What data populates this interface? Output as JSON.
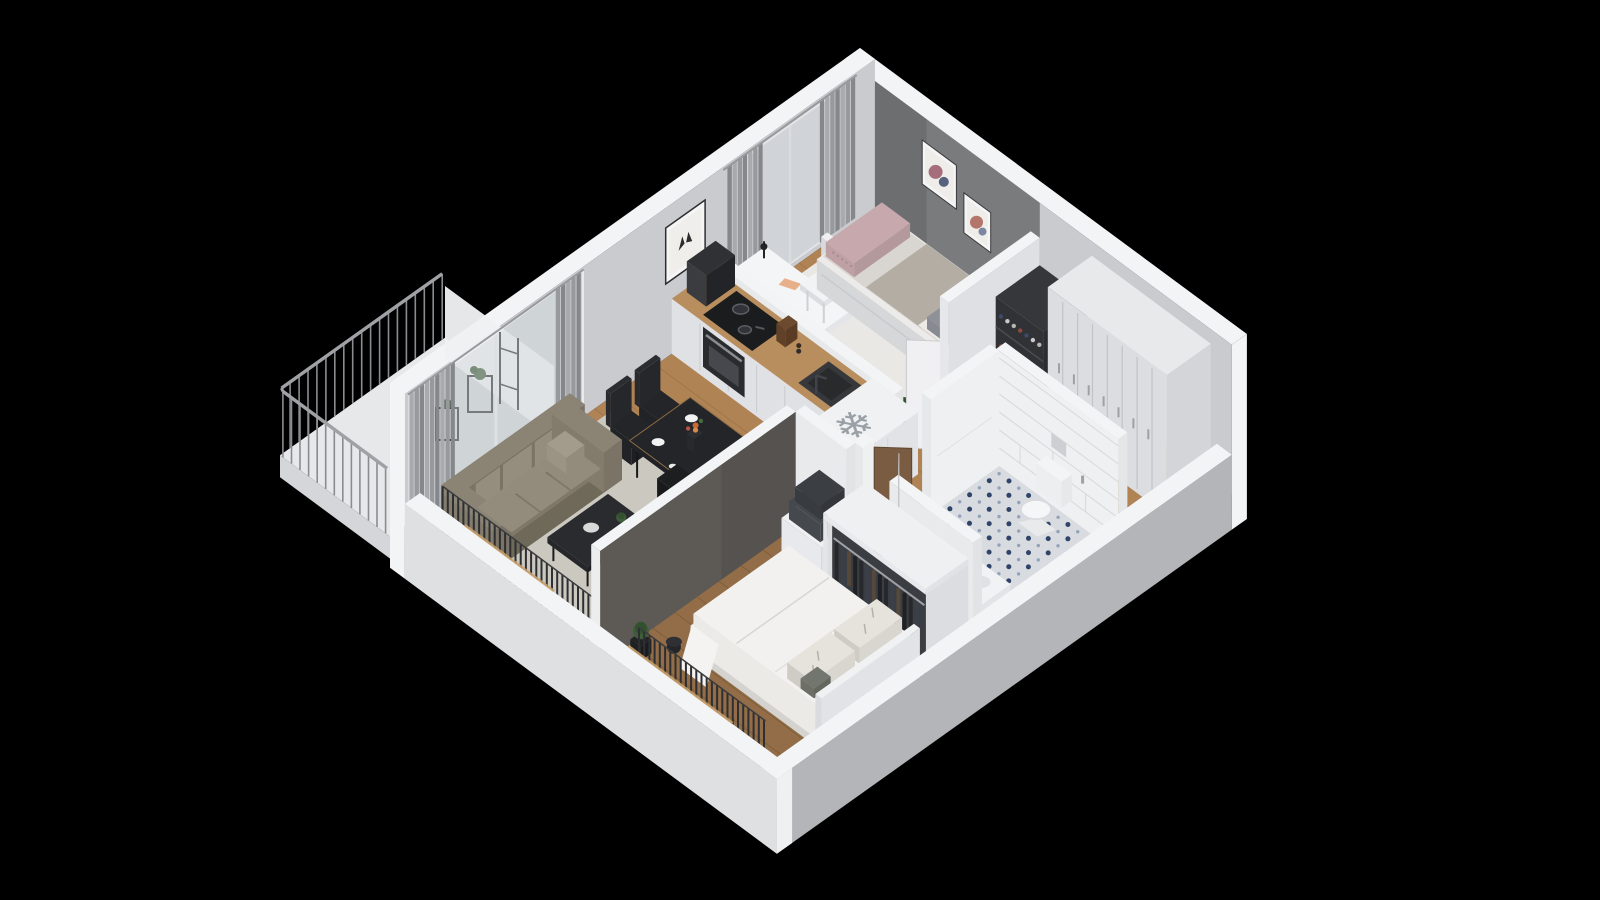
{
  "scene": {
    "description": "isometric-3d-apartment-floorplan-render",
    "background": "#000000",
    "rooms": [
      "living-room",
      "dining-area",
      "kitchen",
      "small-bedroom",
      "bedroom",
      "bathroom",
      "hallway-wardrobe",
      "balcony"
    ],
    "objects": [
      "balcony-railing",
      "balcony-planters",
      "sofa",
      "coffee-table",
      "floor-lamp",
      "living-rug",
      "dining-table",
      "dining-chairs",
      "kitchen-counter",
      "cooktop",
      "oven",
      "coffee-machine",
      "sink",
      "fridge-freezer-unit",
      "daybed",
      "desk",
      "desk-chair",
      "wall-art-frames",
      "butterfly-frame",
      "wardrobe",
      "shoe-rack",
      "toilet",
      "bathroom-vanity",
      "patterned-tile-floor",
      "double-bed",
      "open-closet",
      "storage-boxes",
      "radiators",
      "plants",
      "doors"
    ],
    "icons": {
      "freezer": {
        "name": "snowflake-icon",
        "glyph": "❄"
      }
    }
  },
  "palette": {
    "background": "#000000",
    "wallTop": "#f3f4f6",
    "wallOuterRight": "#b3b5b8",
    "wallOuterBottom": "#dfe0e2",
    "wallInner": "#c9cbce",
    "accentGray": "#797b7d",
    "partitionDark": "#5d5a56",
    "floorWood": "#b08355",
    "floorWoodDark": "#926d47",
    "plankLine": "#7d5833",
    "rugLiving": "#cbc8c0",
    "rugBedroom": "#e9e8e4",
    "bathTileFloor": "#d8dbdf",
    "bathPatternNavy": "#2f4468",
    "bathPatternBlue": "#93a2bb",
    "bathTileWall": "#eef0f1",
    "counterWood": "#b98e5e",
    "cabinetWhite": "#e0e1e4",
    "applianceDark": "#2a2b2e",
    "windowGlass": "#ccd1d5",
    "curtainDark": "#85878b",
    "curtainMid": "#97999d",
    "curtainLight": "#a8aaae",
    "sheer": "#d3d6d9",
    "sofaTaupe": "#847d6e",
    "blackFurniture": "#232528",
    "duvetWhite": "#f2f1ef",
    "bedFrame": "#e8e7e4",
    "wardrobeFront": "#dcdde0",
    "wardrobeLine": "#c2c3c6",
    "clothesDark": "#26282c",
    "boxGray": "#45484c",
    "railingMetal": "#8a8c90",
    "plantGreen": "#3f5d3b",
    "doorWhite": "#f0f0f2",
    "doorWood": "#7a5c42",
    "flowerOrange": "#c96a35",
    "pillowPink": "#c7a9ad",
    "pillowGray": "#8e9298",
    "pillowOlive": "#a79a6f",
    "snowflakeGray": "#9aa1a6",
    "woodTrim": "#c8a06b"
  }
}
